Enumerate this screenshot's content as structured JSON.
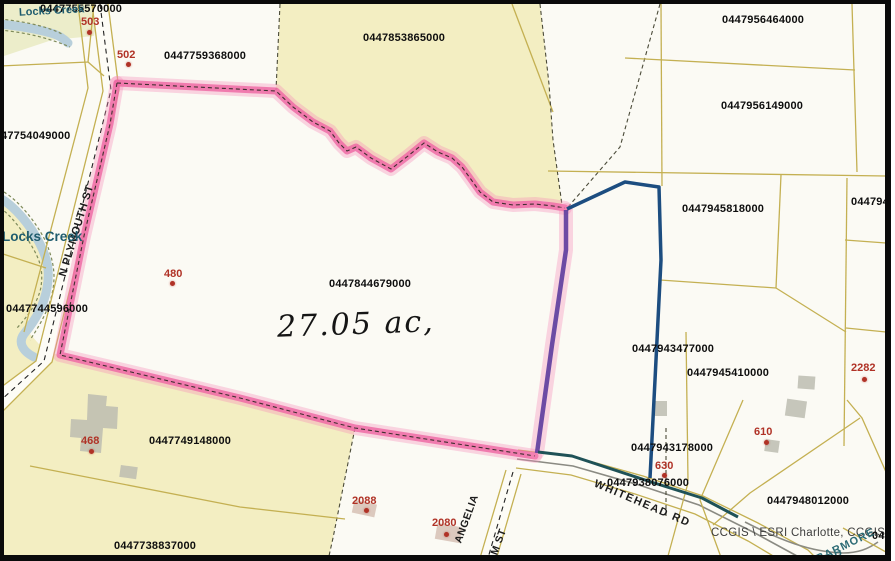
{
  "map": {
    "acreage_annotation": "27.05 ac,",
    "attribution": "CCGIS \\ ESRI Charlotte, CCGIS",
    "parcel_labels": [
      {
        "text": "0447755570000",
        "x": 40,
        "y": 4
      },
      {
        "text": "0447759368000",
        "x": 164,
        "y": 51
      },
      {
        "text": "0447853865000",
        "x": 363,
        "y": 33
      },
      {
        "text": "0447956464000",
        "x": 722,
        "y": 15
      },
      {
        "text": "0447956149000",
        "x": 721,
        "y": 101
      },
      {
        "text": "0447945818000",
        "x": 682,
        "y": 204
      },
      {
        "text": "0447949",
        "x": 851,
        "y": 197
      },
      {
        "text": "47754049000",
        "x": 1,
        "y": 131
      },
      {
        "text": "0447744596000",
        "x": 6,
        "y": 304
      },
      {
        "text": "0447844679000",
        "x": 329,
        "y": 279
      },
      {
        "text": "0447943477000",
        "x": 632,
        "y": 344
      },
      {
        "text": "0447945410000",
        "x": 687,
        "y": 368
      },
      {
        "text": "0447943178000",
        "x": 631,
        "y": 443
      },
      {
        "text": "0447938076000",
        "x": 607,
        "y": 478
      },
      {
        "text": "0447749148000",
        "x": 149,
        "y": 436
      },
      {
        "text": "0447738837000",
        "x": 114,
        "y": 541
      },
      {
        "text": "0447948012000",
        "x": 767,
        "y": 496
      },
      {
        "text": "04",
        "x": 872,
        "y": 531
      }
    ],
    "site_markers": [
      {
        "text": "503",
        "x": 81,
        "y": 17,
        "dot_x": 89,
        "dot_y": 32
      },
      {
        "text": "502",
        "x": 117,
        "y": 50,
        "dot_x": 128,
        "dot_y": 64
      },
      {
        "text": "480",
        "x": 164,
        "y": 269,
        "dot_x": 172,
        "dot_y": 283
      },
      {
        "text": "468",
        "x": 81,
        "y": 436,
        "dot_x": 91,
        "dot_y": 451
      },
      {
        "text": "2088",
        "x": 352,
        "y": 496,
        "dot_x": 366,
        "dot_y": 510
      },
      {
        "text": "2080",
        "x": 432,
        "y": 518,
        "dot_x": 446,
        "dot_y": 534
      },
      {
        "text": "630",
        "x": 655,
        "y": 461,
        "dot_x": 664,
        "dot_y": 475
      },
      {
        "text": "610",
        "x": 754,
        "y": 427,
        "dot_x": 766,
        "dot_y": 442
      },
      {
        "text": "2282",
        "x": 851,
        "y": 363,
        "dot_x": 864,
        "dot_y": 379
      }
    ],
    "road_labels": [
      {
        "text": "N PLYMOUTH ST",
        "x": 77,
        "y": 231,
        "rotate": -73,
        "size": 11,
        "spacing": 0.5
      },
      {
        "text": "WHITEHEAD RD",
        "x": 642,
        "y": 504,
        "rotate": 23,
        "size": 11,
        "spacing": 1.5
      },
      {
        "text": "ANGELIA",
        "x": 467,
        "y": 519,
        "rotate": -70,
        "size": 10.5,
        "spacing": 0.5
      },
      {
        "text": "M ST",
        "x": 499,
        "y": 542,
        "rotate": -70,
        "size": 10.5,
        "spacing": 0.5
      },
      {
        "text": "BARMORE",
        "x": 846,
        "y": 546,
        "rotate": -26,
        "size": 11,
        "spacing": 1,
        "color": "#2b6a74"
      },
      {
        "text": "CIR",
        "x": 833,
        "y": 558,
        "rotate": -15,
        "size": 11,
        "spacing": 1,
        "color": "#2b6a74"
      }
    ],
    "water_labels": [
      {
        "text": "Locks Creek",
        "x": 19,
        "y": 6,
        "size": 11,
        "rotate": -3
      },
      {
        "text": "Locks Creek",
        "x": 2,
        "y": 230,
        "size": 13.5,
        "rotate": 0
      }
    ],
    "colors": {
      "parcel-yellow": "#f3eec2",
      "highlight-pink": "#ef6ba6",
      "highlight-purple": "#5f3f9e",
      "highlight-blue": "#1c4d80",
      "highlight-teal": "#1f5257",
      "creek-blue": "#b8cfdb",
      "line-olive": "#c4b052",
      "marker-red": "#b03226",
      "water-teal": "#1f5c6e"
    }
  }
}
